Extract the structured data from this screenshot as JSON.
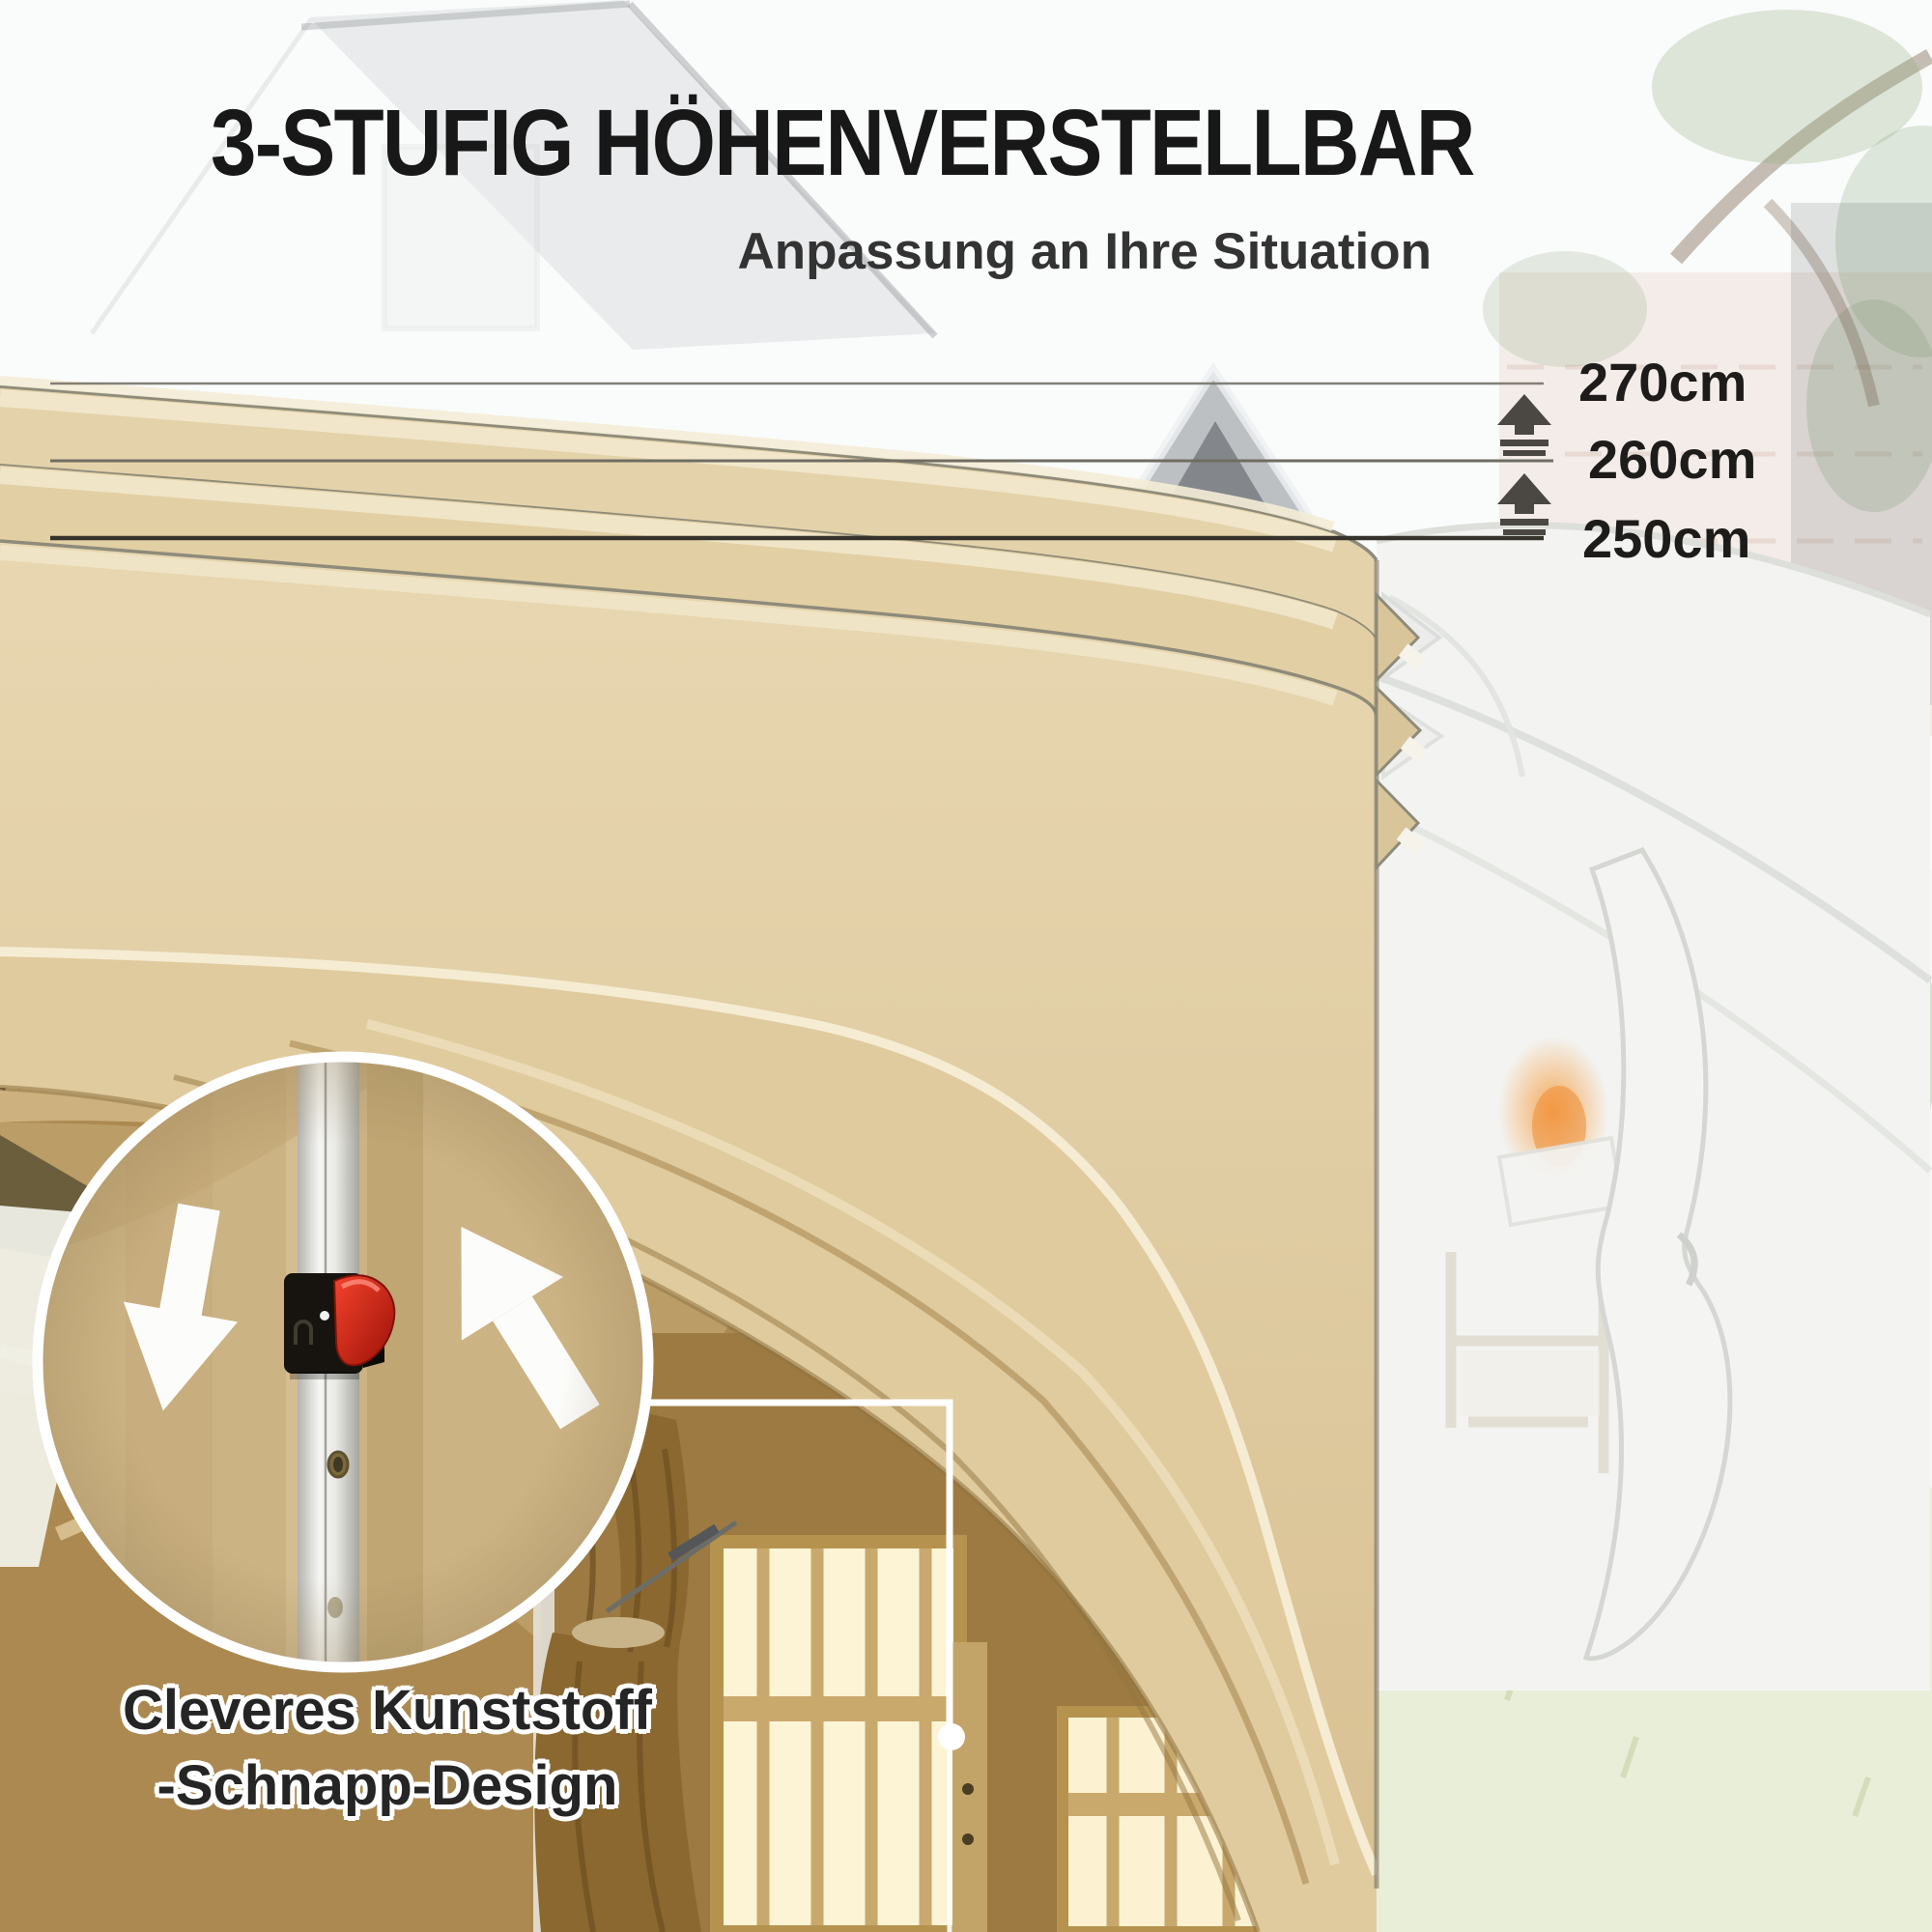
{
  "header": {
    "title": "3-STUFIG HÖHENVERSTELLBAR",
    "subtitle": "Anpassung an Ihre Situation"
  },
  "heights": {
    "h270": "270cm",
    "h260": "260cm",
    "h250": "250cm"
  },
  "caption": {
    "line1": "Cleveres Kunststoff",
    "line2": "-Schnapp-Design"
  },
  "icons": {
    "step_arrows": "step-up-arrow-icon",
    "circle_down": "down-arrow-icon",
    "circle_up": "up-arrow-icon",
    "snap_lock": "snap-lock-lever-icon"
  },
  "colors": {
    "tent_beige": "#e3d1a8",
    "tent_shadow": "#b99a63",
    "piping_cream": "#f5ecd3",
    "snap_red": "#df2f1d",
    "pole_white": "#f1f1ef",
    "text_black": "#1d1c1a"
  }
}
